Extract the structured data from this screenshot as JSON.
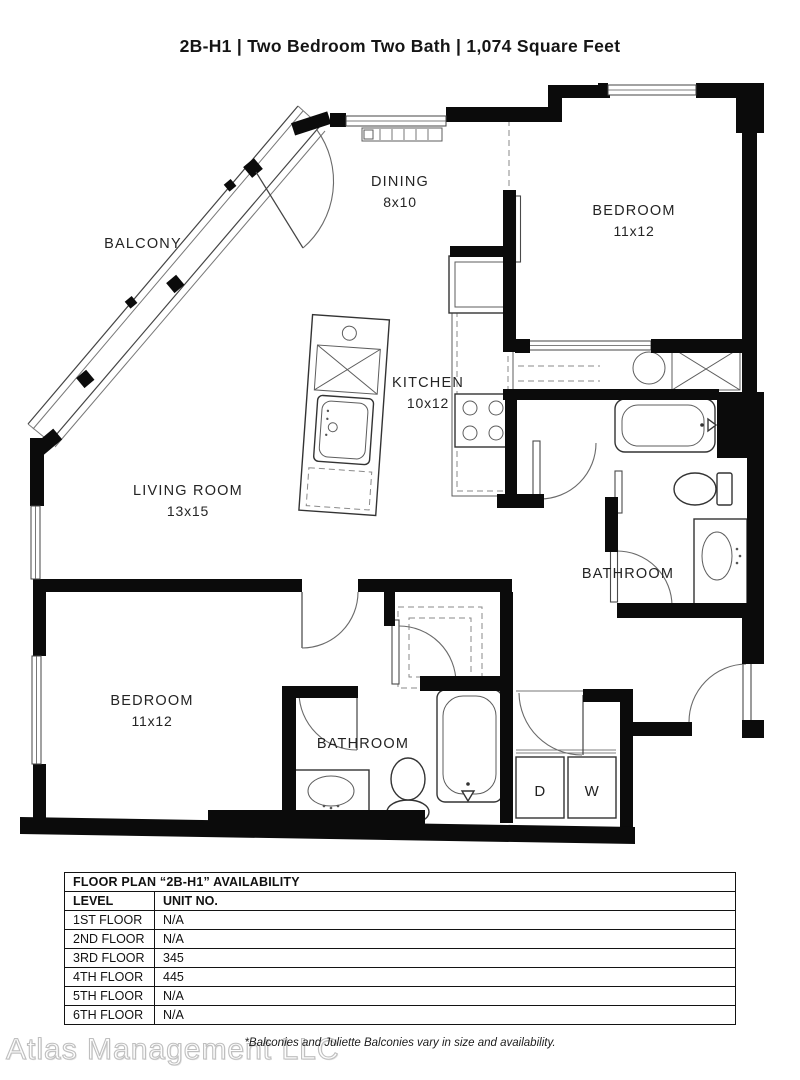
{
  "page": {
    "title": "2B-H1 | Two Bedroom Two Bath | 1,074 Square Feet",
    "watermark": "Atlas Management LLC",
    "footnote": "*Balconies and Juliette Balconies vary in size and availability."
  },
  "floor_plan": {
    "rooms": {
      "balcony": {
        "label": "BALCONY",
        "dims": ""
      },
      "dining": {
        "label": "DINING",
        "dims": "8x10"
      },
      "bedroom1": {
        "label": "BEDROOM",
        "dims": "11x12"
      },
      "kitchen": {
        "label": "KITCHEN",
        "dims": "10x12"
      },
      "living": {
        "label": "LIVING ROOM",
        "dims": "13x15"
      },
      "bathroom1": {
        "label": "BATHROOM",
        "dims": ""
      },
      "bedroom2": {
        "label": "BEDROOM",
        "dims": "11x12"
      },
      "bathroom2": {
        "label": "BATHROOM",
        "dims": ""
      }
    },
    "laundry": {
      "dryer": "D",
      "washer": "W"
    }
  },
  "availability_table": {
    "title": "FLOOR PLAN “2B-H1” AVAILABILITY",
    "columns": [
      "LEVEL",
      "UNIT NO."
    ],
    "rows": [
      {
        "level": "1ST FLOOR",
        "unit": "N/A"
      },
      {
        "level": "2ND FLOOR",
        "unit": "N/A"
      },
      {
        "level": "3RD FLOOR",
        "unit": "345"
      },
      {
        "level": "4TH FLOOR",
        "unit": "445"
      },
      {
        "level": "5TH FLOOR",
        "unit": "N/A"
      },
      {
        "level": "6TH FLOOR",
        "unit": "N/A"
      }
    ]
  }
}
